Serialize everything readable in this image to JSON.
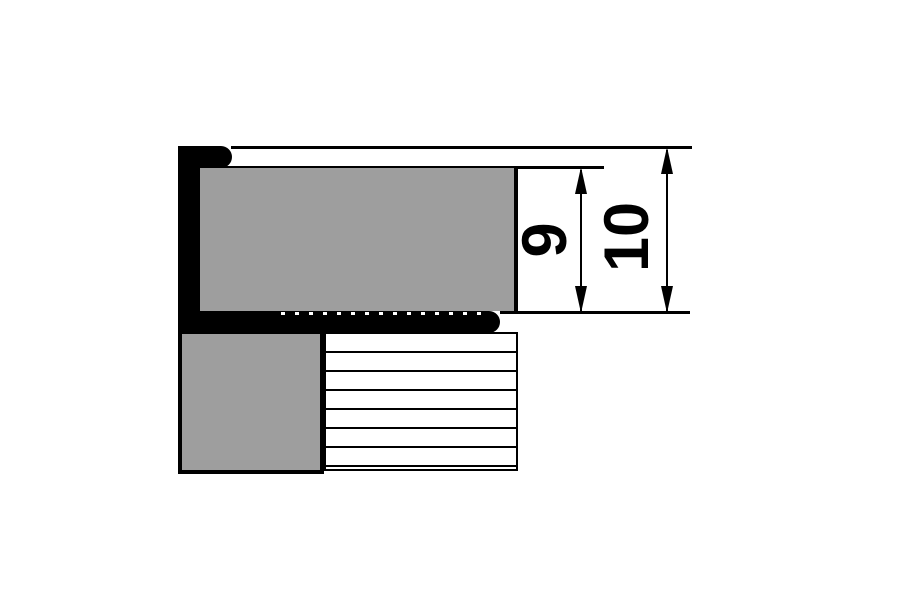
{
  "diagram": {
    "name": "tile-edge-profile-cross-section",
    "dimension_labels": {
      "inner": "9",
      "outer": "10"
    },
    "colors": {
      "background": "#ffffff",
      "profile": "#000000",
      "line": "#000000",
      "tile": "#9e9e9e",
      "hatch_background": "#ffffff"
    },
    "hatch_rows": 7
  }
}
